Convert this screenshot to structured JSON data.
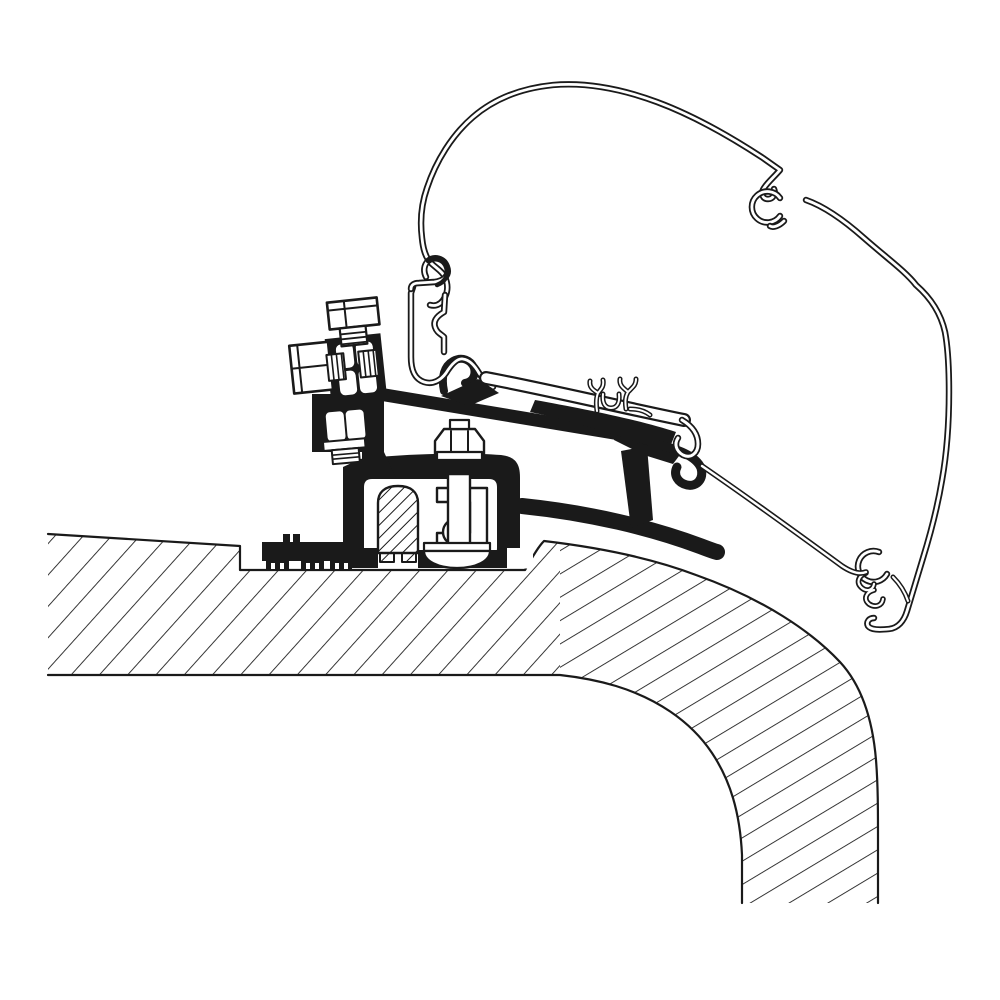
{
  "canvas": {
    "width": 1000,
    "height": 1000,
    "background": "#ffffff"
  },
  "colors": {
    "ink": "#1a1a1a",
    "paper": "#ffffff"
  },
  "diagram": {
    "shapes": [
      {
        "name": "roof-slab-left",
        "kind": "path",
        "d": "M 48,534 L 240,546 L 240,570 L 525,570 C 531,560 537,548 544,541 L 560,544 L 560,675 L 48,675 Z",
        "fill": "url(#hatch-roof-a)"
      },
      {
        "name": "roof-slab-curve",
        "kind": "path",
        "d": "M 544,541 C 612,549 662,562 696,575 C 764,599 812,632 840,662 C 864,688 873,724 876,760 C 878,785 878,810 878,840 L 878,903 L 742,903 L 742,855 C 740,812 730,780 712,753 C 690,720 655,698 616,686 C 596,680 578,677 560,675 L 560,544 Z",
        "fill": "url(#hatch-roof-b)"
      },
      {
        "name": "roof-edge-outer",
        "kind": "path",
        "d": "M 48,534 L 240,546 L 240,570 L 525,570 C 531,560 537,548 544,541 C 612,549 662,562 696,575 C 764,599 812,632 840,662 C 864,688 873,724 876,760 C 878,785 878,810 878,840 L 878,903",
        "stroke": "#1a1a1a",
        "width": 2.2
      },
      {
        "name": "roof-edge-inner",
        "kind": "path",
        "d": "M 48,675 L 560,675 C 578,677 596,680 616,686 C 655,698 690,720 712,753 C 730,780 740,812 742,855 L 742,903",
        "stroke": "#1a1a1a",
        "width": 2.2
      },
      {
        "name": "adapter-roof-strap",
        "kind": "path",
        "d": "M 522,506 C 590,513 652,528 700,546 C 708,549 713,551 717,552",
        "stroke": "#1a1a1a",
        "width": 16
      },
      {
        "name": "adapter-post",
        "kind": "path",
        "d": "M 621,451 L 647,446 L 653,520 L 631,528 Z",
        "fill": "#1a1a1a"
      },
      {
        "name": "adapter-joint",
        "kind": "path",
        "d": "M 616,426 L 652,436 C 667,440 676,447 679,456 L 673,464 L 644,455 L 614,440 Z",
        "fill": "#1a1a1a"
      },
      {
        "name": "adapter-rail-bar",
        "kind": "path",
        "d": "M 355,390 L 656,440",
        "stroke": "#1a1a1a",
        "width": 13,
        "cap": "butt"
      },
      {
        "name": "adapter-bar-thickening",
        "kind": "path",
        "d": "M 535,400 C 580,408 640,420 676,432 L 668,452 C 620,436 570,420 530,412 Z",
        "fill": "#1a1a1a"
      },
      {
        "name": "adapter-hook-right",
        "kind": "path",
        "d": "M 655,444 C 678,449 696,456 701,468 C 704,479 697,487 687,485 C 678,483 673,475 677,467",
        "stroke": "#1a1a1a",
        "width": 9
      },
      {
        "name": "adapter-hook-left",
        "kind": "path",
        "d": "M 444,391 C 441,377 444,366 453,361 C 462,356 471,360 474,368 C 476,376 472,382 465,383",
        "stroke": "#1a1a1a",
        "width": 8
      },
      {
        "name": "adapter-hook-left-base",
        "kind": "path",
        "d": "M 441,396 L 478,379 L 499,393 L 469,406 Z",
        "fill": "#1a1a1a"
      },
      {
        "name": "awning-profile-skin",
        "kind": "path",
        "d": "M 430,305 C 437,307 442,303 445,297 C 448,291 448,284 445,277 C 442,271 436,268 431,263 C 425,257 423,248 422,238 C 420,222 421,205 427,188 C 436,161 452,135 473,117 C 495,98 523,88 553,85 C 588,82 622,89 657,102 C 692,115 731,137 763,158 L 780,170 C 774,177 768,182 764,188 C 760,194 763,199 768,199 C 773,199 776,194 774,189",
        "layers": [
          {
            "stroke": "#1a1a1a",
            "width": 6.4
          },
          {
            "stroke": "#ffffff",
            "width": 2.8
          }
        ]
      },
      {
        "name": "awning-profile-clip-ring",
        "kind": "path",
        "d": "M 780,216 A 15.5,15.5 0 1 1 780,198",
        "layers": [
          {
            "stroke": "#1a1a1a",
            "width": 6.4
          },
          {
            "stroke": "#ffffff",
            "width": 2.8
          }
        ]
      },
      {
        "name": "awning-profile-clip-foot",
        "kind": "path",
        "d": "M 784,221 C 779,226 773,228 770,226",
        "layers": [
          {
            "stroke": "#1a1a1a",
            "width": 6.4
          },
          {
            "stroke": "#ffffff",
            "width": 2.8
          }
        ]
      },
      {
        "name": "awning-profile-right-skin",
        "kind": "path",
        "d": "M 806,200 C 826,207 846,222 864,238 C 888,259 906,272 916,285 C 932,299 941,314 945,332 C 948,348 949,368 949,392 C 949,422 947,452 942,480 C 938,504 931,532 923,558 C 918,575 912,594 907,611 C 904,621 898,628 889,629 C 879,630 871,630 868,626 C 866,622 869,618 874,618",
        "layers": [
          {
            "stroke": "#1a1a1a",
            "width": 6.4
          },
          {
            "stroke": "#ffffff",
            "width": 2.8
          }
        ]
      },
      {
        "name": "awning-profile-end-ring",
        "kind": "path",
        "d": "M 887,574 A 15.5,15.5 0 1 1 879,552",
        "layers": [
          {
            "stroke": "#1a1a1a",
            "width": 6.4
          },
          {
            "stroke": "#ffffff",
            "width": 2.8
          }
        ]
      },
      {
        "name": "awning-profile-end-link",
        "kind": "path",
        "d": "M 893,577 C 900,584 905,592 908,601",
        "layers": [
          {
            "stroke": "#1a1a1a",
            "width": 5
          },
          {
            "stroke": "#ffffff",
            "width": 2
          }
        ]
      },
      {
        "name": "awning-profile-end-hooks",
        "kind": "path",
        "d": "M 866,573 C 858,576 856,583 862,588 C 867,592 873,590 874,584 M 874,590 C 866,592 863,599 869,604 C 875,608 882,606 883,599",
        "layers": [
          {
            "stroke": "#1a1a1a",
            "width": 5.6
          },
          {
            "stroke": "#ffffff",
            "width": 2.2
          }
        ]
      },
      {
        "name": "awning-profile-skirt",
        "kind": "path",
        "d": "M 702,466 C 740,492 790,528 842,566 C 851,572 859,575 866,572",
        "layers": [
          {
            "stroke": "#1a1a1a",
            "width": 5.6
          },
          {
            "stroke": "#ffffff",
            "width": 2.4
          }
        ]
      },
      {
        "name": "foot-body",
        "kind": "path",
        "d": "M 343,467 L 360,459 C 400,454 462,452 501,455 C 516,457 520,464 520,478 L 520,568 L 343,568 Z",
        "fill": "#1a1a1a"
      },
      {
        "name": "foot-bracket-neck",
        "kind": "path",
        "d": "M 362,452 L 384,452 L 396,478 L 362,478 Z",
        "fill": "#1a1a1a"
      },
      {
        "name": "foot-cavity",
        "kind": "path",
        "d": "M 372,479 L 489,479 Q 497,479 497,487 L 497,548 Q 497,556 489,556 L 372,556 Q 364,556 364,548 L 364,487 Q 364,479 372,479 Z",
        "fill": "#ffffff"
      },
      {
        "name": "foot-bottom-stubs",
        "kind": "path",
        "d": "M 364,548 L 378,548 L 378,568 L 364,568 Z M 418,550 L 427,550 L 427,568 L 418,568 Z M 488,550 L 497,550 L 497,568 L 488,568 Z",
        "fill": "#1a1a1a"
      },
      {
        "name": "foot-step-notch",
        "kind": "path",
        "d": "M 507,548 L 533,548 L 533,568.5 L 507,568.5 Z",
        "fill": "#ffffff"
      },
      {
        "name": "foot-plug-gap",
        "kind": "path",
        "d": "M 378,556 L 418,556 L 418,568.5 L 378,568.5 Z",
        "fill": "#ffffff"
      },
      {
        "name": "foot-serrated-pad",
        "kind": "path",
        "d": "M 262,542 L 352,542 L 352,561 L 262,561 Z M 266,558 L 289,558 L 289,569 L 266,569 Z M 301,558 L 324,558 L 324,569 L 301,569 Z M 330,558 L 352,558 L 352,569 L 330,569 Z M 283,534 L 290,534 L 290,542 L 283,542 Z M 293,534 L 300,534 L 300,542 L 293,542 Z",
        "fill": "#1a1a1a"
      },
      {
        "name": "foot-serration-slots",
        "kind": "path",
        "d": "M 271,563 L 275,563 L 275,569 L 271,569 Z M 280,563 L 284,563 L 284,569 L 280,569 Z M 306,563 L 310,563 L 310,569 L 306,569 Z M 315,563 L 319,563 L 319,569 L 315,569 Z M 335,563 L 339,563 L 339,569 L 335,569 Z M 344,563 L 348,563 L 348,569 L 344,569 Z",
        "fill": "#ffffff"
      },
      {
        "name": "roof-plug",
        "kind": "path",
        "d": "M 378,553 L 378,503 C 378,492 385,486 398,486 C 411,486 418,492 418,503 L 418,553 Z",
        "fill": "url(#hatch-plug)",
        "stroke": "#1a1a1a",
        "width": 2.4
      },
      {
        "name": "roof-plug-legs",
        "kind": "path",
        "d": "M 380,553 L 394,553 L 394,562 L 380,562 Z M 402,553 L 416,553 L 416,562 L 402,562 Z",
        "fill": "url(#hatch-plug)",
        "stroke": "#1a1a1a",
        "width": 2
      },
      {
        "name": "clamp-claw",
        "kind": "path",
        "d": "M 437,488 L 487,488 L 487,547 L 437,547 L 437,533 L 470,533 L 470,502 L 437,502 Z",
        "fill": "#ffffff",
        "stroke": "#1a1a1a",
        "width": 2.4
      },
      {
        "name": "clamp-ball",
        "kind": "circle",
        "cx": 456,
        "cy": 532,
        "r": 13,
        "fill": "#ffffff",
        "stroke": "#1a1a1a",
        "width": 2.4
      },
      {
        "name": "clamp-bolt-shaft",
        "kind": "path",
        "d": "M 448,474 L 470,474 L 470,545 L 448,545 Z",
        "fill": "#ffffff",
        "stroke": "#1a1a1a",
        "width": 2.4
      },
      {
        "name": "clamp-base-plate",
        "kind": "path",
        "d": "M 424,543 L 490,543 L 490,551 L 424,551 Z",
        "fill": "#ffffff",
        "stroke": "#1a1a1a",
        "width": 2.2
      },
      {
        "name": "clamp-base-dome",
        "kind": "path",
        "d": "M 424,551 C 424,561 438,568 457,568 C 476,568 490,561 490,551 Z",
        "fill": "#ffffff",
        "stroke": "#1a1a1a",
        "width": 2.2
      },
      {
        "name": "clamp-nut",
        "kind": "path",
        "d": "M 435,458 L 435,441 L 444,429 L 475,429 L 484,441 L 484,458 Z",
        "fill": "#ffffff",
        "stroke": "#1a1a1a",
        "width": 2.4
      },
      {
        "name": "clamp-nut-facets",
        "kind": "path",
        "d": "M 451,431 L 451,457 M 468,431 L 468,457",
        "stroke": "#1a1a1a",
        "width": 2
      },
      {
        "name": "clamp-nut-washer",
        "kind": "path",
        "d": "M 437,452 L 482,452 L 482,460 L 437,460 Z",
        "fill": "#ffffff",
        "stroke": "#1a1a1a",
        "width": 2.2
      },
      {
        "name": "clamp-bolt-tip",
        "kind": "path",
        "d": "M 450,420 L 469,420 L 469,429 L 450,429 Z",
        "fill": "#ffffff",
        "stroke": "#1a1a1a",
        "width": 2.2
      },
      {
        "name": "rail-channel-left",
        "kind": "path",
        "d": "M 413,287 L 411,293 L 411,357 C 411,371 415,379 424,382 C 433,385 441,380 446,373 C 451,365 457,358 463,359 C 470,360 475,366 479,373 C 483,380 488,384 493,387",
        "layers": [
          {
            "stroke": "#1a1a1a",
            "width": 6.4
          },
          {
            "stroke": "#ffffff",
            "width": 2.8
          }
        ]
      },
      {
        "name": "rail-channel-hook",
        "kind": "path",
        "d": "M 411,289 C 411,285 414,283 419,283 L 434,282 C 444,281 450,275 447,267 C 444,258 434,256 428,261 C 424,265 423,271 426,277",
        "layers": [
          {
            "stroke": "#1a1a1a",
            "width": 6.4
          },
          {
            "stroke": "#ffffff",
            "width": 2.8
          }
        ]
      },
      {
        "name": "rail-channel-right",
        "kind": "path",
        "d": "M 445,295 L 444,312 C 437,316 433,321 435,327 C 437,333 441,334 444,337 L 444,352",
        "layers": [
          {
            "stroke": "#1a1a1a",
            "width": 6.4
          },
          {
            "stroke": "#ffffff",
            "width": 2.8
          }
        ]
      },
      {
        "name": "rail-channel-hook-heavy",
        "kind": "path",
        "d": "M 428,261 C 435,256 444,258 447,267 C 449,275 445,282 437,285",
        "stroke": "#1a1a1a",
        "width": 4.5
      },
      {
        "name": "rail-flange",
        "kind": "path",
        "d": "M 486,378 C 550,390 620,407 684,420",
        "layers": [
          {
            "stroke": "#1a1a1a",
            "width": 14
          },
          {
            "stroke": "#ffffff",
            "width": 9.6
          }
        ]
      },
      {
        "name": "rail-flange-end-hook",
        "kind": "path",
        "d": "M 682,420 C 692,426 698,434 698,444 C 698,453 691,459 683,455 C 676,451 674,444 678,438",
        "layers": [
          {
            "stroke": "#1a1a1a",
            "width": 6.5
          },
          {
            "stroke": "#ffffff",
            "width": 3
          }
        ]
      },
      {
        "name": "rail-spring-clip-left",
        "kind": "path",
        "d": "M 597,411 C 596,404 596,398 598,393 M 598,393 C 593,390 589,387 590,381 M 598,393 C 602,388 604,386 603,380",
        "layers": [
          {
            "stroke": "#1a1a1a",
            "width": 5
          },
          {
            "stroke": "#ffffff",
            "width": 2
          }
        ]
      },
      {
        "name": "rail-spring-clip-cup",
        "kind": "path",
        "d": "M 603,394 C 602,403 605,408 611,408 C 617,408 620,403 619,394",
        "layers": [
          {
            "stroke": "#1a1a1a",
            "width": 5
          },
          {
            "stroke": "#ffffff",
            "width": 2
          }
        ]
      },
      {
        "name": "rail-spring-clip-right",
        "kind": "path",
        "d": "M 626,409 C 625,402 625,397 628,392 M 628,392 C 623,388 619,385 620,379 M 628,392 C 633,387 636,385 636,379 M 630,409 C 638,409 645,411 650,415",
        "layers": [
          {
            "stroke": "#1a1a1a",
            "width": 5
          },
          {
            "stroke": "#ffffff",
            "width": 2
          }
        ]
      },
      {
        "name": "lock-bracket-body",
        "kind": "path",
        "d": "M 312,394 L 384,394 L 384,478 L 362,478 L 362,452 L 312,452 Z",
        "fill": "#1a1a1a"
      },
      {
        "name": "clamp-block",
        "kind": "path",
        "d": "M 326,336 L 382,336 L 382,398 L 326,398 Z",
        "fill": "#1a1a1a",
        "transform": "rotate(-6 355 350)"
      },
      {
        "name": "clamp-block-facet-tl",
        "kind": "rect",
        "x": 336,
        "y": 343,
        "w": 17,
        "h": 24,
        "rx": 5,
        "fill": "#ffffff",
        "transform": "rotate(-6 355 350)"
      },
      {
        "name": "clamp-block-facet-tr",
        "kind": "rect",
        "x": 356,
        "y": 343,
        "w": 17,
        "h": 24,
        "rx": 5,
        "fill": "#ffffff",
        "transform": "rotate(-6 355 350)"
      },
      {
        "name": "clamp-block-facet-bl",
        "kind": "rect",
        "x": 336,
        "y": 370,
        "w": 17,
        "h": 24,
        "rx": 5,
        "fill": "#ffffff",
        "transform": "rotate(-6 355 350)"
      },
      {
        "name": "clamp-block-facet-br",
        "kind": "rect",
        "x": 356,
        "y": 370,
        "w": 17,
        "h": 24,
        "rx": 5,
        "fill": "#ffffff",
        "transform": "rotate(-6 355 350)"
      },
      {
        "name": "top-bolt-head",
        "kind": "rect",
        "x": 332,
        "y": 300,
        "w": 50,
        "h": 27,
        "fill": "#ffffff",
        "stroke": "#1a1a1a",
        "width": 2.6,
        "transform": "rotate(-6 355 350)"
      },
      {
        "name": "top-bolt-head-facets",
        "kind": "path",
        "d": "M 349,300 L 349,327 M 332,308 L 382,308",
        "stroke": "#1a1a1a",
        "width": 2,
        "transform": "rotate(-6 355 350)"
      },
      {
        "name": "top-bolt-shank",
        "kind": "rect",
        "x": 342,
        "y": 327,
        "w": 26,
        "h": 18,
        "fill": "#ffffff",
        "stroke": "#1a1a1a",
        "width": 2.2,
        "transform": "rotate(-6 355 350)"
      },
      {
        "name": "top-bolt-threads",
        "kind": "path",
        "d": "M 342,333 L 368,333 M 342,338 L 368,338 M 342,343 L 368,343",
        "stroke": "#1a1a1a",
        "width": 1.8,
        "transform": "rotate(-6 355 350)"
      },
      {
        "name": "side-bolt-head",
        "kind": "rect",
        "x": 290,
        "y": 339,
        "w": 39,
        "h": 48,
        "fill": "#ffffff",
        "stroke": "#1a1a1a",
        "width": 2.6,
        "transform": "rotate(-6 355 350)"
      },
      {
        "name": "side-bolt-head-facets",
        "kind": "path",
        "d": "M 290,362 L 329,362 M 298,339 L 298,387",
        "stroke": "#1a1a1a",
        "width": 2,
        "transform": "rotate(-6 355 350)"
      },
      {
        "name": "side-bolt-shank-outer",
        "kind": "rect",
        "x": 326,
        "y": 352,
        "w": 17,
        "h": 26,
        "fill": "#ffffff",
        "stroke": "#1a1a1a",
        "width": 2,
        "transform": "rotate(-6 355 350)"
      },
      {
        "name": "side-bolt-threads-outer",
        "kind": "path",
        "d": "M 331,352 L 331,378 M 336,352 L 336,378 M 341,352 L 341,378",
        "stroke": "#1a1a1a",
        "width": 1.6,
        "transform": "rotate(-6 355 350)"
      },
      {
        "name": "side-bolt-shank-inner",
        "kind": "rect",
        "x": 358,
        "y": 352,
        "w": 18,
        "h": 26,
        "fill": "#ffffff",
        "stroke": "#1a1a1a",
        "width": 2,
        "transform": "rotate(-6 355 350)"
      },
      {
        "name": "side-bolt-threads-inner",
        "kind": "path",
        "d": "M 363,352 L 363,378 M 368,352 L 368,378 M 373,352 L 373,378",
        "stroke": "#1a1a1a",
        "width": 1.6,
        "transform": "rotate(-6 355 350)"
      },
      {
        "name": "lock-nut-facet-left",
        "kind": "rect",
        "x": 327,
        "y": 411,
        "w": 18,
        "h": 29,
        "rx": 4,
        "fill": "#ffffff",
        "transform": "rotate(-5 345 430)"
      },
      {
        "name": "lock-nut-facet-right",
        "kind": "rect",
        "x": 347,
        "y": 411,
        "w": 18,
        "h": 29,
        "rx": 4,
        "fill": "#ffffff",
        "transform": "rotate(-5 345 430)"
      },
      {
        "name": "lock-washer",
        "kind": "rect",
        "x": 322,
        "y": 440,
        "w": 42,
        "h": 9,
        "fill": "#ffffff",
        "stroke": "#1a1a1a",
        "width": 2,
        "transform": "rotate(-5 345 430)"
      },
      {
        "name": "lock-threads",
        "kind": "rect",
        "x": 330,
        "y": 449,
        "w": 27,
        "h": 14,
        "fill": "#ffffff",
        "stroke": "#1a1a1a",
        "width": 2,
        "transform": "rotate(-5 345 430)"
      },
      {
        "name": "lock-thread-lines",
        "kind": "path",
        "d": "M 330,454 L 357,454 M 330,458 L 357,458",
        "stroke": "#1a1a1a",
        "width": 1.6,
        "transform": "rotate(-5 345 430)"
      }
    ]
  }
}
